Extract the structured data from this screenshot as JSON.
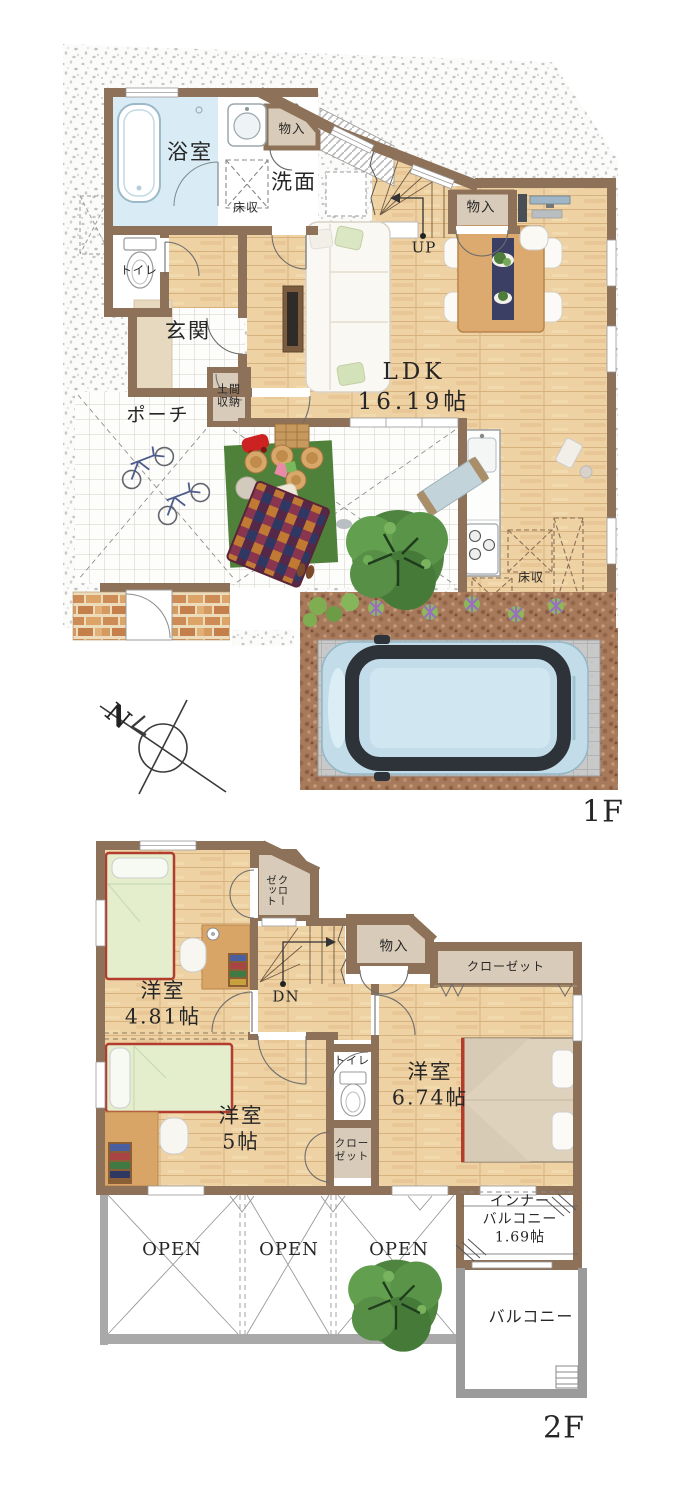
{
  "floor1": {
    "label": "1F",
    "compass_north": "N",
    "rooms": {
      "bath": "浴室",
      "washroom": "洗面",
      "storage_top": "物入",
      "floor_storage_wash": "床収",
      "toilet": "トイレ",
      "entrance": "玄関",
      "doma_storage": "土間\n収納",
      "porch": "ポーチ",
      "stairs_up": "UP",
      "storage_ldk": "物入",
      "ldk": "LDK\n16.19帖",
      "floor_storage_kitchen": "床収"
    }
  },
  "floor2": {
    "label": "2F",
    "rooms": {
      "closet_west": "クロー\nゼット",
      "stairs_down": "DN",
      "storage": "物入",
      "closet_main": "クローゼット",
      "bedroom_west": "洋室\n4.81帖",
      "toilet": "トイレ",
      "bedroom_main": "洋室\n6.74帖",
      "bedroom_south": "洋室\n5帖",
      "closet_south": "クロー\nゼット",
      "inner_balcony": "インナー\nバルコニー\n1.69帖",
      "open_1": "OPEN",
      "open_2": "OPEN",
      "open_3": "OPEN",
      "balcony": "バルコニー"
    }
  },
  "colors": {
    "wall": "#8d7158",
    "wood": "#eed2a4",
    "closet_tan": "#d9cbb9",
    "bath_blue": "#d9ebf4",
    "balcony_wall": "#9b9b9b",
    "bed_green": "#e4eecd",
    "bed_frame_red": "#b23c2e",
    "car_body": "#c2dde9"
  }
}
